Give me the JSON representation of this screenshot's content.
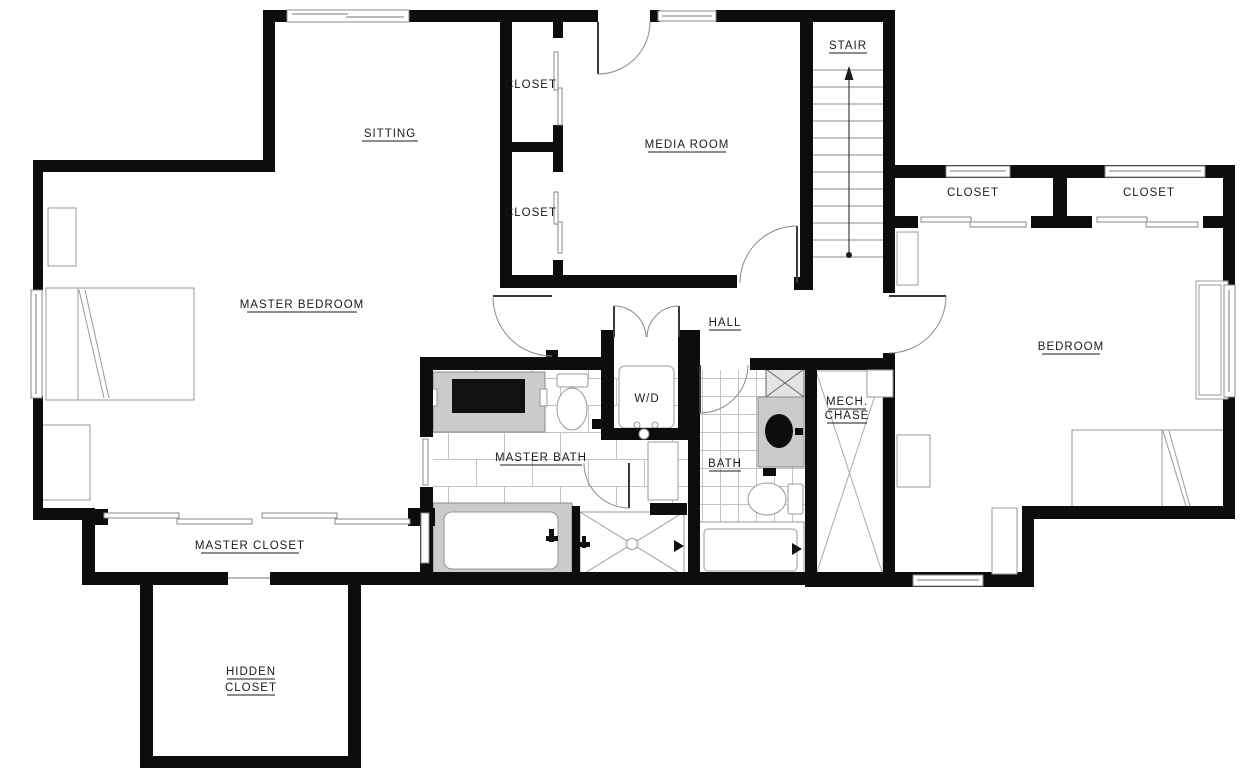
{
  "rooms": {
    "sitting": "SITTING",
    "closet_upper": "CLOSET",
    "closet_lower": "CLOSET",
    "media_room": "MEDIA ROOM",
    "stair": "STAIR",
    "east_closet_left": "CLOSET",
    "east_closet_right": "CLOSET",
    "master_bedroom": "MASTER BEDROOM",
    "hall": "HALL",
    "bedroom": "BEDROOM",
    "laundry": "W/D",
    "mech_chase_line1": "MECH.",
    "mech_chase_line2": "CHASE",
    "master_bath": "MASTER BATH",
    "bath": "BATH",
    "master_closet": "MASTER CLOSET",
    "hidden_closet_line1": "HIDDEN",
    "hidden_closet_line2": "CLOSET"
  },
  "stair_info": {
    "direction": "up",
    "tread_count": 12
  },
  "colors": {
    "wall": "#0d0d0d",
    "fixture_gray": "#cbcbcb",
    "counter_dark": "#111111",
    "tile_line": "#c4c4c4",
    "door_arc": "#8a8a8a",
    "background": "#ffffff"
  }
}
